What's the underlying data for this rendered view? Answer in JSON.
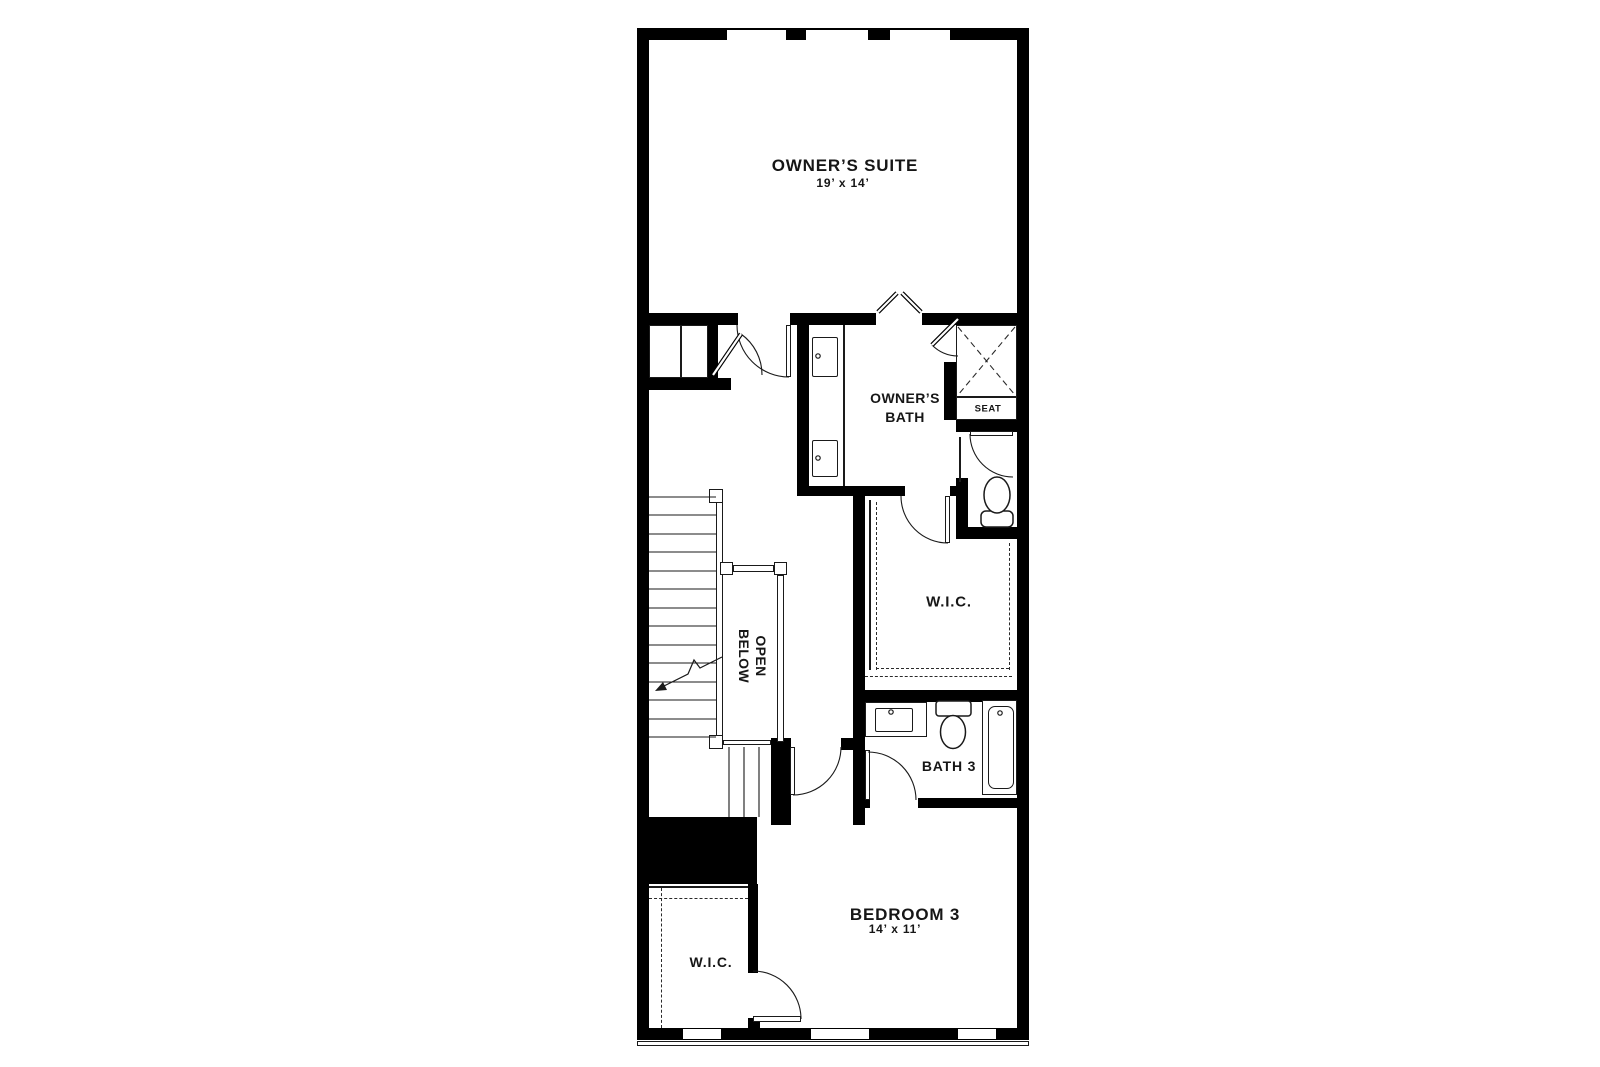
{
  "floorplan": {
    "background": "#ffffff",
    "wall_color": "#000000",
    "line_color": "#1a1a1a",
    "rooms": {
      "owners_suite": {
        "name": "OWNER’S SUITE",
        "dims": "19’ x 14’"
      },
      "owners_bath": {
        "name_line1": "OWNER’S",
        "name_line2": "BATH"
      },
      "shower_seat": {
        "label": "SEAT"
      },
      "owners_closet": {
        "label": "W.I.C."
      },
      "stairwell": {
        "label_line1": "OPEN",
        "label_line2": "BELOW"
      },
      "bath_3": {
        "label": "BATH 3"
      },
      "bedroom_3": {
        "name": "BEDROOM 3",
        "dims": "14’ x 11’"
      },
      "bedroom_closet": {
        "label": "W.I.C."
      }
    }
  }
}
